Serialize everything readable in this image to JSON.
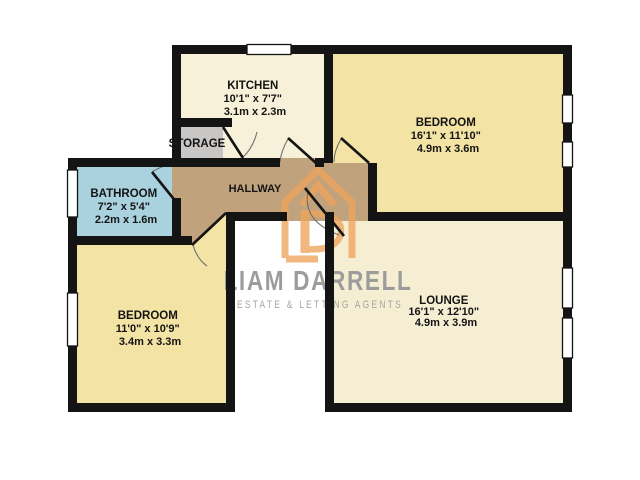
{
  "floorplan": {
    "background": "#ffffff",
    "wall_color": "#141414",
    "label_color": "#141414",
    "door_arc_color": "#6f6f6f",
    "rooms": [
      {
        "id": "kitchen",
        "name": "KITCHEN",
        "size_imperial": "10'1\" x 7'7\"",
        "size_metric": "3.1m x 2.3m",
        "floor_color": "#f8f1d9"
      },
      {
        "id": "bedroom-top-right",
        "name": "BEDROOM",
        "size_imperial": "16'1\" x 11'10\"",
        "size_metric": "4.9m x 3.6m",
        "floor_color": "#f3e3a4"
      },
      {
        "id": "bathroom",
        "name": "BATHROOM",
        "size_imperial": "7'2\" x 5'4\"",
        "size_metric": "2.2m x 1.6m",
        "floor_color": "#a9d2de"
      },
      {
        "id": "bedroom-bottom-left",
        "name": "BEDROOM",
        "size_imperial": "11'0\" x 10'9\"",
        "size_metric": "3.4m x 3.3m",
        "floor_color": "#f3e3a4"
      },
      {
        "id": "lounge",
        "name": "LOUNGE",
        "size_imperial": "16'1\" x 12'10\"",
        "size_metric": "4.9m x 3.9m",
        "floor_color": "#f6eed3"
      },
      {
        "id": "hallway",
        "name": "HALLWAY",
        "floor_color": "#c0a27c"
      },
      {
        "id": "storage",
        "name": "STORAGE",
        "floor_color": "#c8c7c5"
      }
    ],
    "watermark": {
      "brand": "LIAM DARRELL",
      "tagline": "ESTATE & LETTING AGENTS",
      "brand_color": "#9c9c9c",
      "tagline_color": "#a6a6a0",
      "logo_color": "#eea45c"
    }
  }
}
